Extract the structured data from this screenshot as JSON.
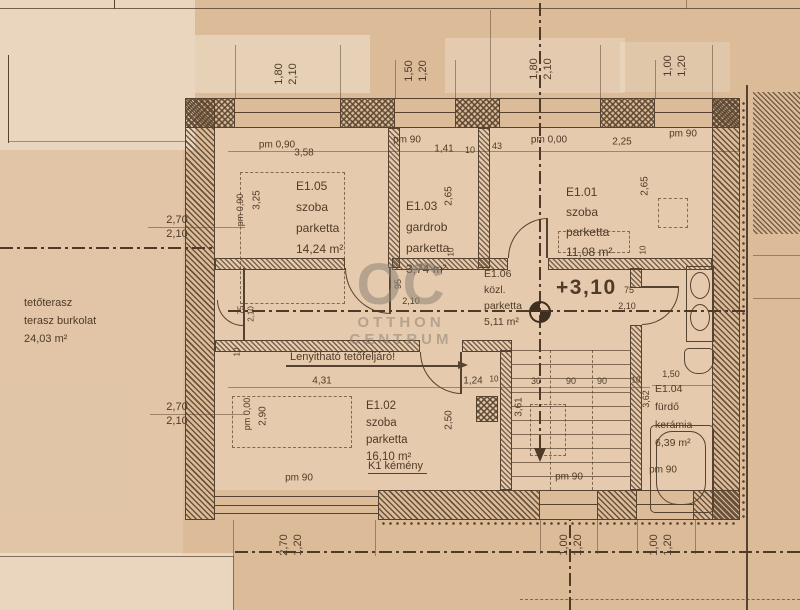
{
  "meta": {
    "type": "scanned architectural floor plan",
    "language": "hu"
  },
  "colors": {
    "paper": "#dcbb99",
    "ink": "#564230",
    "watermark": "#8e8379"
  },
  "watermark": {
    "initials": "OC",
    "line1": "OTTHON",
    "line2": "CENTRUM"
  },
  "level": {
    "value": "+3,10"
  },
  "terrace": {
    "line1": "tetőterasz",
    "line2": "terasz burkolat",
    "line3": "24,03 m²"
  },
  "rooms": {
    "e105": {
      "id": "E1.05",
      "use": "szoba",
      "finish": "parketta",
      "area": "14,24 m²"
    },
    "e103": {
      "id": "E1.03",
      "use": "gardrob",
      "finish": "parketta",
      "area": "3,74 m²"
    },
    "e101": {
      "id": "E1.01",
      "use": "szoba",
      "finish": "parketta",
      "area": "11,08 m²"
    },
    "e106": {
      "id": "E1.06",
      "use": "közl.",
      "finish": "parketta",
      "area": "5,11 m²"
    },
    "e102": {
      "id": "E1.02",
      "use": "szoba",
      "finish": "parketta",
      "area": "16,10 m²"
    },
    "e104": {
      "id": "E1.04",
      "use": "fürdő",
      "finish": "kerámia",
      "area": "6,39 m²"
    }
  },
  "notes": {
    "attic_hatch": "Lenyitható tetőfeljáró!",
    "chimney": "K1 kémény"
  },
  "dimension_labels": [
    {
      "t": "1,80",
      "x": 279,
      "y": 74,
      "r": -90,
      "s": 11
    },
    {
      "t": "2,10",
      "x": 293,
      "y": 74,
      "r": -90,
      "s": 11
    },
    {
      "t": "1,50",
      "x": 409,
      "y": 71,
      "r": -90,
      "s": 11
    },
    {
      "t": "1,20",
      "x": 423,
      "y": 71,
      "r": -90,
      "s": 11
    },
    {
      "t": "1,80",
      "x": 534,
      "y": 69,
      "r": -90,
      "s": 11
    },
    {
      "t": "2,10",
      "x": 548,
      "y": 69,
      "r": -90,
      "s": 11
    },
    {
      "t": "1,00",
      "x": 668,
      "y": 66,
      "r": -90,
      "s": 11
    },
    {
      "t": "1,20",
      "x": 682,
      "y": 66,
      "r": -90,
      "s": 11
    },
    {
      "t": "pm 0,90",
      "x": 277,
      "y": 145,
      "s": 10
    },
    {
      "t": "3,58",
      "x": 304,
      "y": 153,
      "s": 10
    },
    {
      "t": "pm 90",
      "x": 407,
      "y": 140,
      "s": 10
    },
    {
      "t": "1,41",
      "x": 444,
      "y": 149,
      "s": 10
    },
    {
      "t": "10",
      "x": 470,
      "y": 150,
      "s": 9
    },
    {
      "t": "43",
      "x": 497,
      "y": 146,
      "s": 9
    },
    {
      "t": "pm 0,00",
      "x": 549,
      "y": 140,
      "s": 10
    },
    {
      "t": "2,25",
      "x": 622,
      "y": 142,
      "s": 10
    },
    {
      "t": "pm 90",
      "x": 683,
      "y": 134,
      "s": 10
    },
    {
      "t": "2,70",
      "x": 177,
      "y": 220,
      "s": 11
    },
    {
      "t": "2,10",
      "x": 177,
      "y": 234,
      "s": 11
    },
    {
      "t": "pm 0,90",
      "x": 240,
      "y": 210,
      "r": -90,
      "s": 9
    },
    {
      "t": "3,25",
      "x": 257,
      "y": 200,
      "r": -90,
      "s": 10
    },
    {
      "t": "2,65",
      "x": 449,
      "y": 196,
      "r": -90,
      "s": 10
    },
    {
      "t": "10",
      "x": 451,
      "y": 252,
      "r": -90,
      "s": 8
    },
    {
      "t": "2,65",
      "x": 645,
      "y": 186,
      "r": -90,
      "s": 10
    },
    {
      "t": "10",
      "x": 643,
      "y": 250,
      "r": -90,
      "s": 8
    },
    {
      "t": "75",
      "x": 241,
      "y": 310,
      "r": -90,
      "s": 8
    },
    {
      "t": "2,10",
      "x": 251,
      "y": 314,
      "r": -90,
      "s": 8
    },
    {
      "t": "10",
      "x": 237,
      "y": 352,
      "r": -90,
      "s": 8
    },
    {
      "t": "95",
      "x": 398,
      "y": 284,
      "r": -90,
      "s": 9
    },
    {
      "t": "2,10",
      "x": 411,
      "y": 301,
      "s": 9
    },
    {
      "t": "75",
      "x": 629,
      "y": 290,
      "s": 9
    },
    {
      "t": "2,10",
      "x": 627,
      "y": 306,
      "s": 9
    },
    {
      "t": "2,70",
      "x": 177,
      "y": 407,
      "s": 11
    },
    {
      "t": "2,10",
      "x": 177,
      "y": 421,
      "s": 11
    },
    {
      "t": "pm 0,00",
      "x": 247,
      "y": 414,
      "r": -90,
      "s": 9
    },
    {
      "t": "2,90",
      "x": 263,
      "y": 416,
      "r": -90,
      "s": 10
    },
    {
      "t": "4,31",
      "x": 322,
      "y": 381,
      "s": 10
    },
    {
      "t": "1,24",
      "x": 473,
      "y": 381,
      "s": 10
    },
    {
      "t": "10",
      "x": 494,
      "y": 379,
      "s": 8
    },
    {
      "t": "2,50",
      "x": 449,
      "y": 420,
      "r": -90,
      "s": 10
    },
    {
      "t": "3,61",
      "x": 519,
      "y": 407,
      "r": -90,
      "s": 10
    },
    {
      "t": "30",
      "x": 536,
      "y": 381,
      "s": 9
    },
    {
      "t": "90",
      "x": 571,
      "y": 381,
      "s": 9
    },
    {
      "t": "90",
      "x": 602,
      "y": 381,
      "s": 9
    },
    {
      "t": "10",
      "x": 636,
      "y": 380,
      "s": 8
    },
    {
      "t": "3,62",
      "x": 646,
      "y": 399,
      "r": -90,
      "s": 9
    },
    {
      "t": "1,50",
      "x": 671,
      "y": 374,
      "s": 9
    },
    {
      "t": "pm 90",
      "x": 299,
      "y": 478,
      "s": 10
    },
    {
      "t": "pm 90",
      "x": 569,
      "y": 477,
      "s": 10
    },
    {
      "t": "pm 90",
      "x": 663,
      "y": 470,
      "s": 10
    },
    {
      "t": "2,70",
      "x": 284,
      "y": 545,
      "r": -90,
      "s": 11
    },
    {
      "t": "1,20",
      "x": 298,
      "y": 545,
      "r": -90,
      "s": 11
    },
    {
      "t": "1,00",
      "x": 564,
      "y": 545,
      "r": -90,
      "s": 11
    },
    {
      "t": "1,20",
      "x": 578,
      "y": 545,
      "r": -90,
      "s": 11
    },
    {
      "t": "1,00",
      "x": 654,
      "y": 545,
      "r": -90,
      "s": 11
    },
    {
      "t": "1,20",
      "x": 668,
      "y": 545,
      "r": -90,
      "s": 11
    }
  ]
}
